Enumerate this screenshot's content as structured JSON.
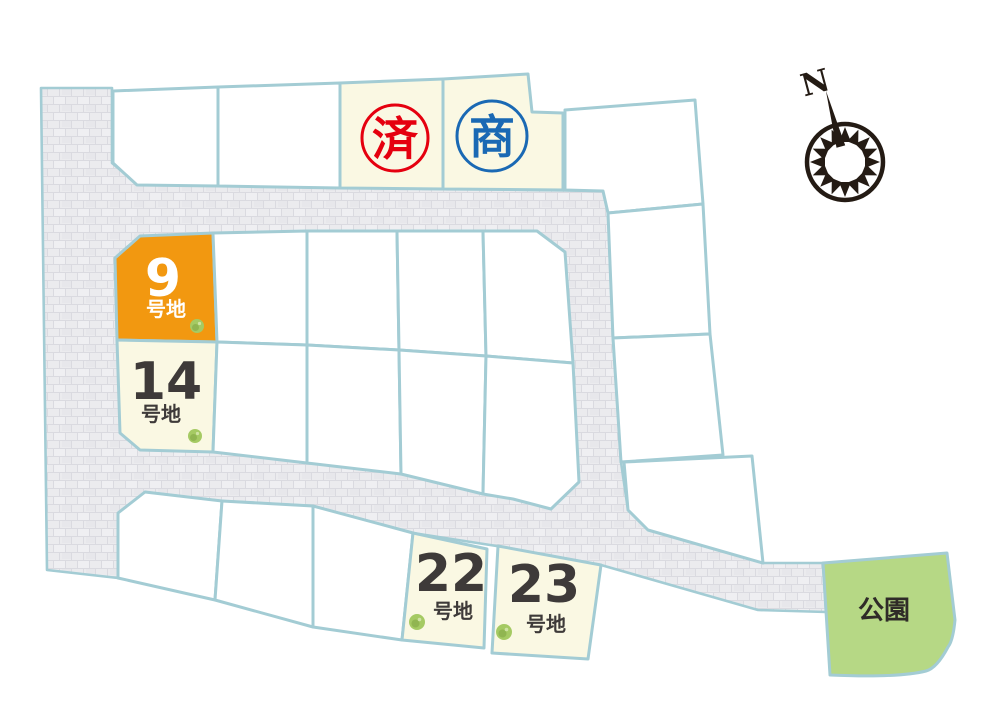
{
  "lots": {
    "lot9": {
      "number": "9",
      "suffix": "号地"
    },
    "lot14": {
      "number": "14",
      "suffix": "号地"
    },
    "lot22": {
      "number": "22",
      "suffix": "号地"
    },
    "lot23": {
      "number": "23",
      "suffix": "号地"
    }
  },
  "stamps": {
    "sold": "済",
    "commercial": "商"
  },
  "park": {
    "label": "公園"
  },
  "compass": {
    "north_label": "N"
  },
  "colors": {
    "accent-orange": "#f29810",
    "cream": "#faf8e3",
    "sold-red": "#e5000f",
    "commercial-blue": "#1a69b4",
    "park-green": "#b6d885",
    "border-teal": "#a3ccd4",
    "road-gray": "#ebebee",
    "road-line": "#dadae0",
    "text-dark": "#3e3a39",
    "tree-green": "#a5ca63",
    "compass-dark": "#241b14"
  }
}
